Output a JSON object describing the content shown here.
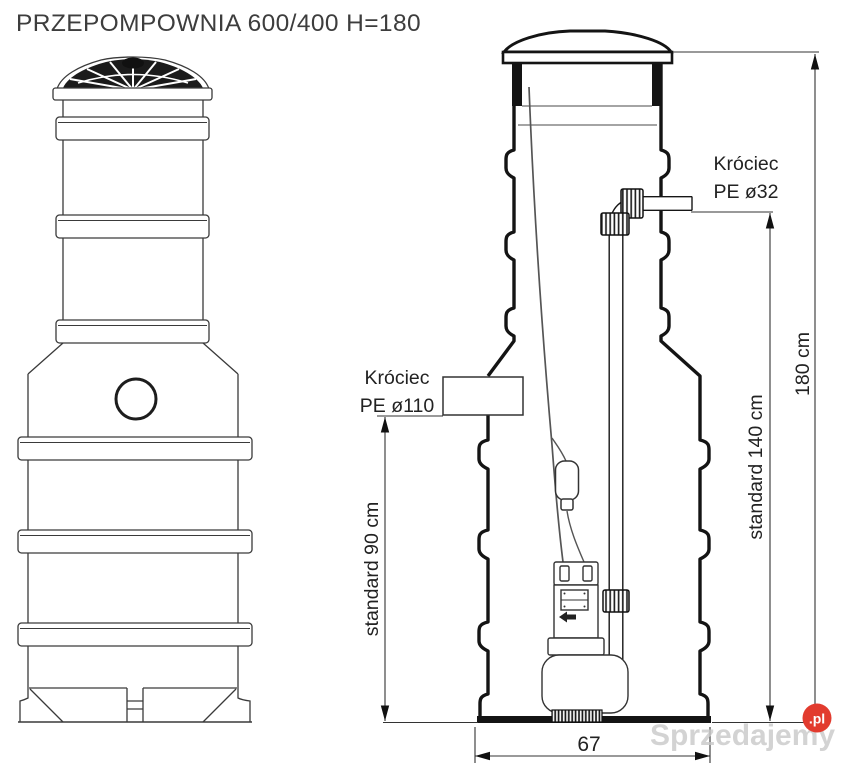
{
  "title": "PRZEPOMPOWNIA 600/400 H=180",
  "section_view": {
    "outlet_label_line1": "Króciec",
    "outlet_label_line2": "PE ø32",
    "inlet_label_line1": "Króciec",
    "inlet_label_line2": "PE ø110",
    "dim_total_height": "180 cm",
    "dim_outlet_height": "standard 140 cm",
    "dim_inlet_height": "standard 90 cm",
    "dim_base_width": "67"
  },
  "colors": {
    "line": "#2e2e2e",
    "wall": "#141414",
    "watermark_gray": "#c9c9c9",
    "watermark_red": "#e23b2e"
  },
  "watermark": {
    "text": "Sprzedajemy",
    "suffix": ".pl"
  }
}
